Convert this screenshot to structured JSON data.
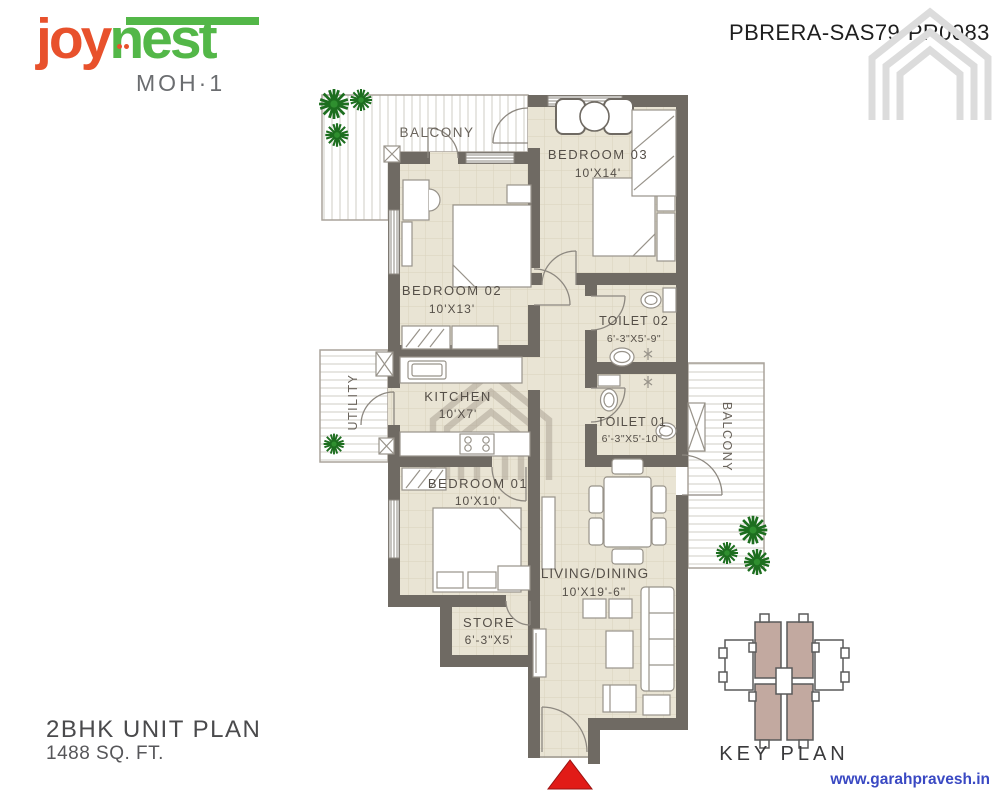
{
  "branding": {
    "logo_joy": "joy",
    "logo_nest": "nest",
    "logo_sub": "MOH·1"
  },
  "header": {
    "rera_number": "PBRERA-SAS79-PR0083"
  },
  "plan": {
    "rooms": [
      {
        "id": "balcony-top",
        "name": "BALCONY",
        "dim": ""
      },
      {
        "id": "bedroom-03",
        "name": "BEDROOM 03",
        "dim": "10'X14'"
      },
      {
        "id": "bedroom-02",
        "name": "BEDROOM 02",
        "dim": "10'X13'"
      },
      {
        "id": "toilet-02",
        "name": "TOILET 02",
        "dim": "6'-3\"X5'-9\""
      },
      {
        "id": "kitchen",
        "name": "KITCHEN",
        "dim": "10'X7'"
      },
      {
        "id": "utility",
        "name": "UTILITY",
        "dim": ""
      },
      {
        "id": "toilet-01",
        "name": "TOILET 01",
        "dim": "6'-3\"X5'-10\""
      },
      {
        "id": "bedroom-01",
        "name": "BEDROOM 01",
        "dim": "10'X10'"
      },
      {
        "id": "store",
        "name": "STORE",
        "dim": "6'-3\"X5'"
      },
      {
        "id": "living-dining",
        "name": "LIVING/DINING",
        "dim": "10'X19'-6\""
      },
      {
        "id": "balcony-right",
        "name": "BALCONY",
        "dim": ""
      }
    ]
  },
  "footer": {
    "unit_title": "2BHK UNIT PLAN",
    "unit_area": "1488 SQ. FT."
  },
  "key_plan": {
    "label": "KEY PLAN"
  },
  "website": {
    "text": "www.garahpravesh.in"
  },
  "colors": {
    "logo_orange": "#e8512c",
    "logo_green": "#53b748",
    "wall_grey": "#6f6a63",
    "floor_beige": "#e9e4d4",
    "keyplan_mauve": "#c2a9a0",
    "website_blue": "#3a49c3",
    "entry_arrow_red": "#e11b17"
  }
}
